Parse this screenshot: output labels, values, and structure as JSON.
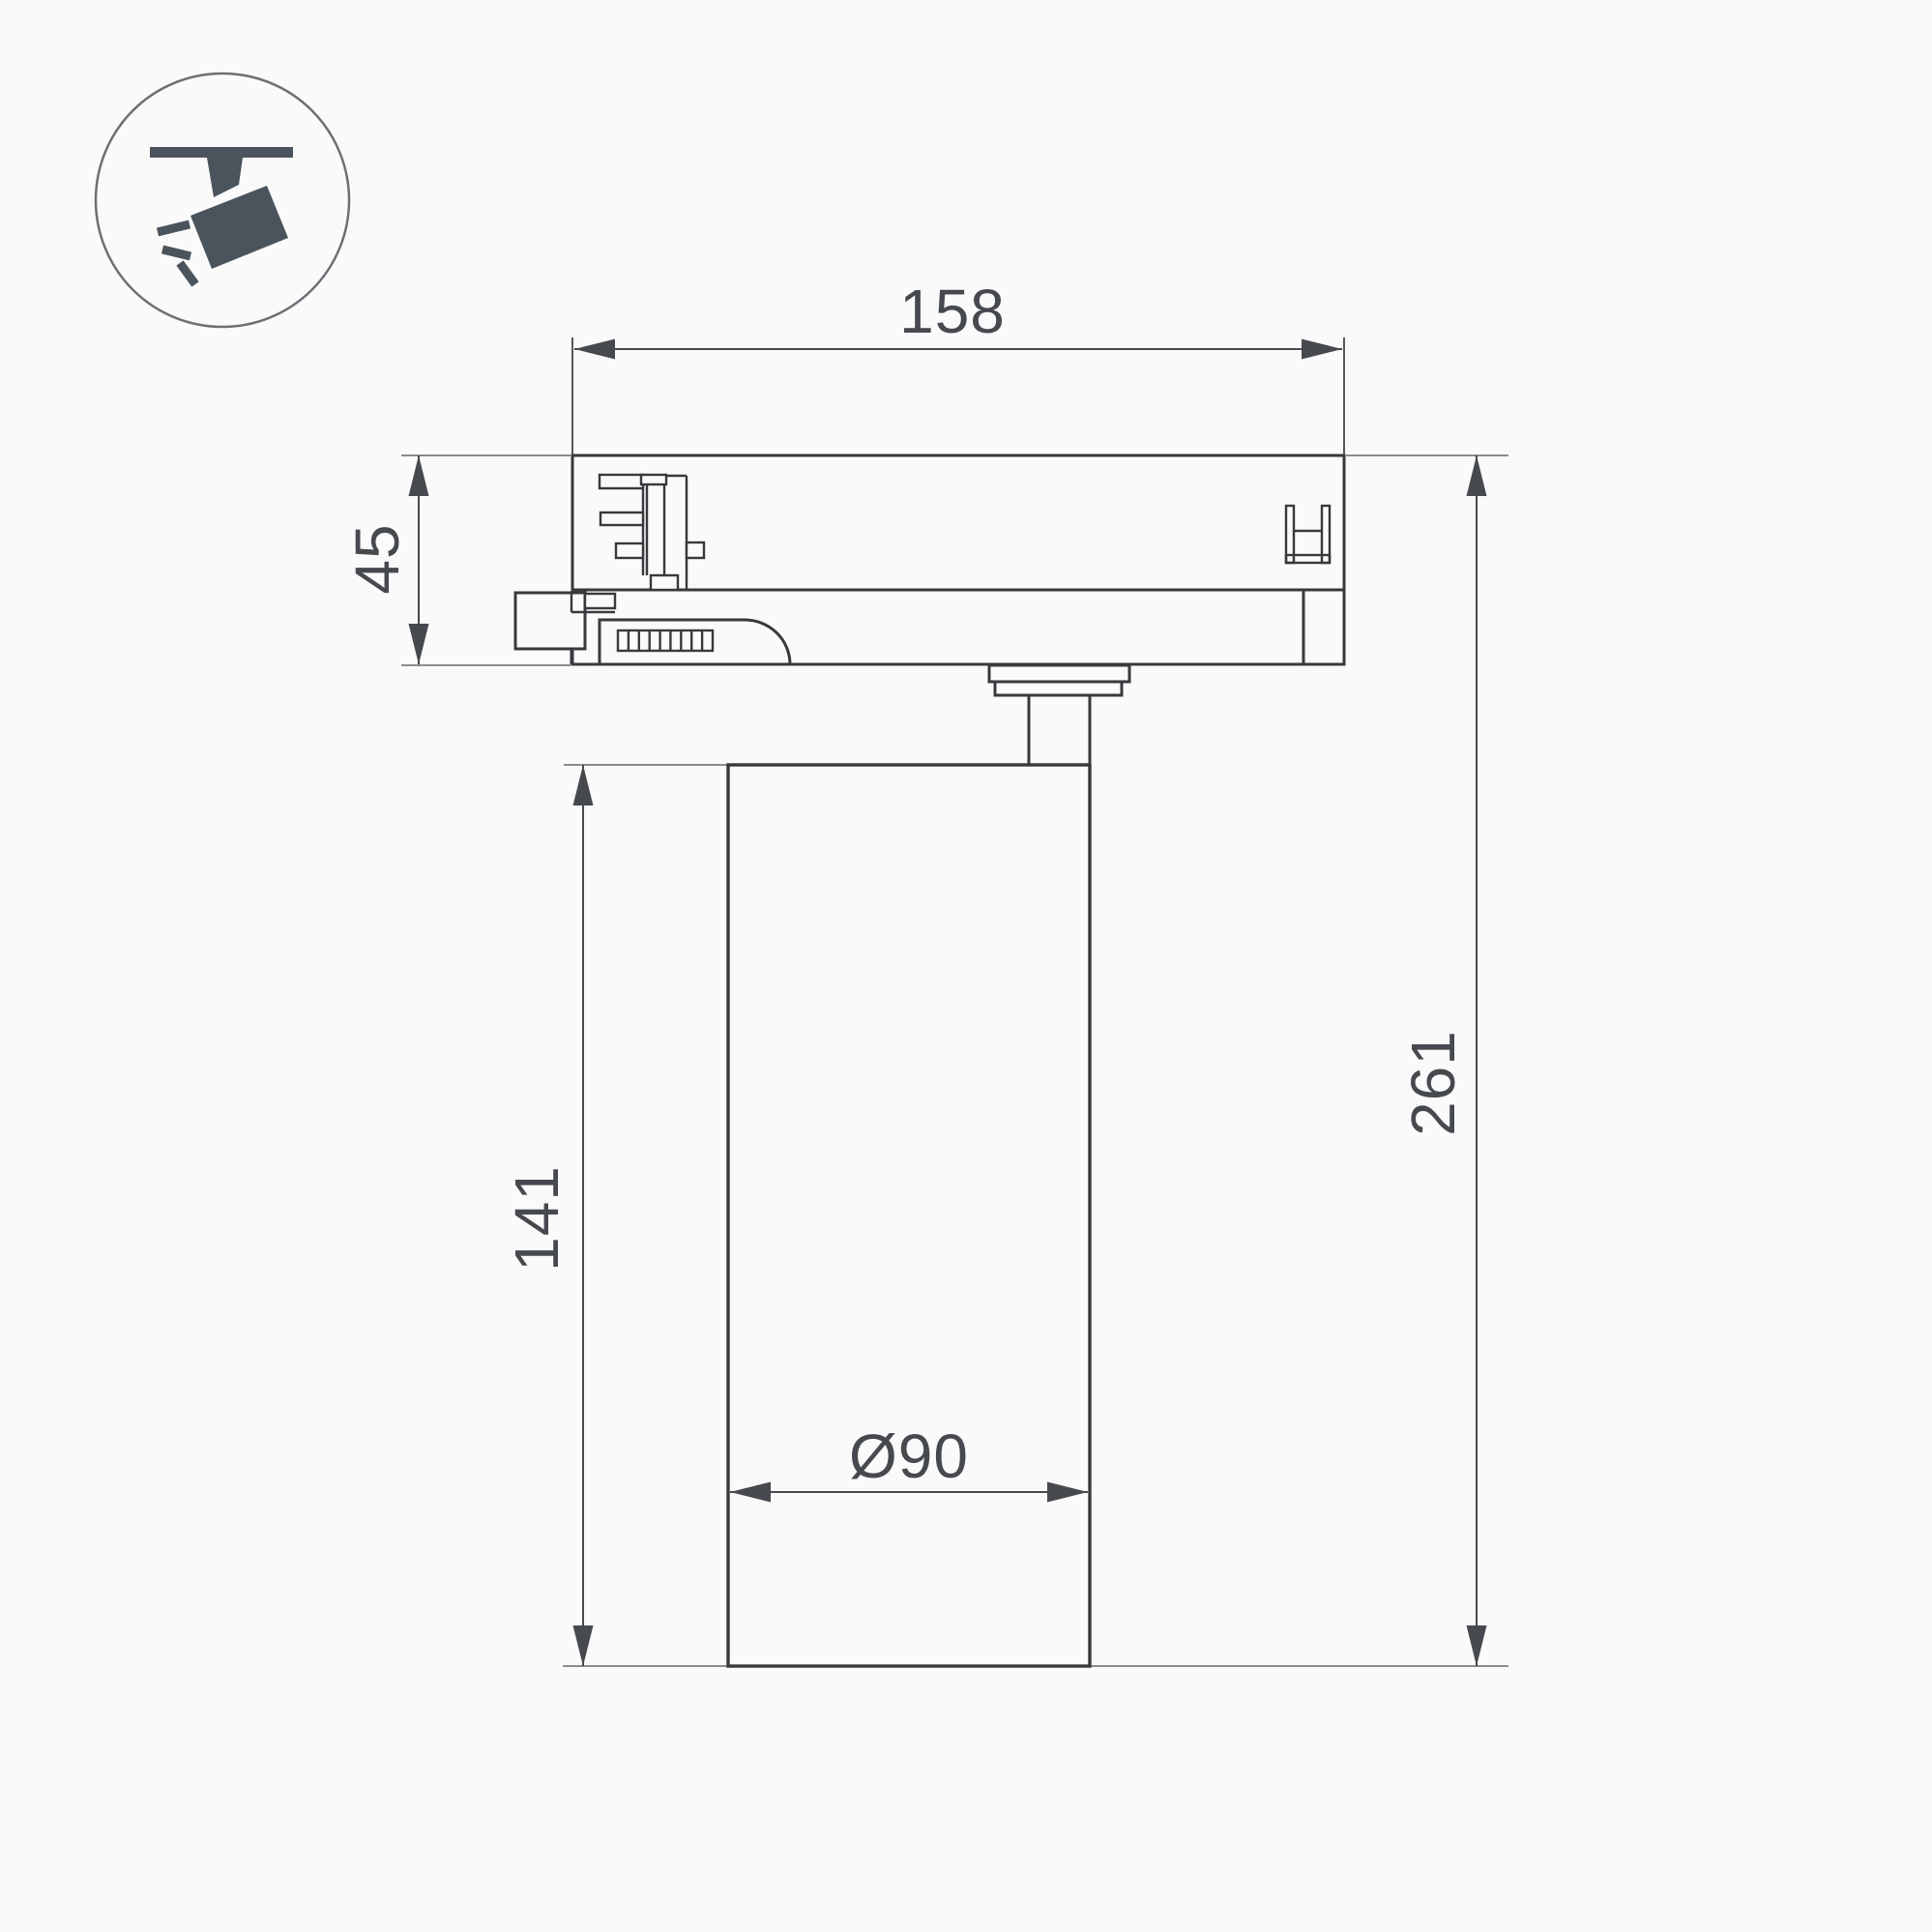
{
  "drawing": {
    "title": "track-spotlight-dimension-drawing",
    "dimensions": {
      "track_adapter_width": "158",
      "adapter_height": "45",
      "body_height": "141",
      "total_height": "261",
      "body_diameter": "Ø90"
    },
    "icon": {
      "name": "track-spotlight-icon"
    },
    "colors": {
      "outline": "#37393d",
      "dimension_text": "#46494e",
      "extension_line": "#7a7d80",
      "icon_fill": "#4b545c",
      "background": "#fafafa"
    }
  }
}
